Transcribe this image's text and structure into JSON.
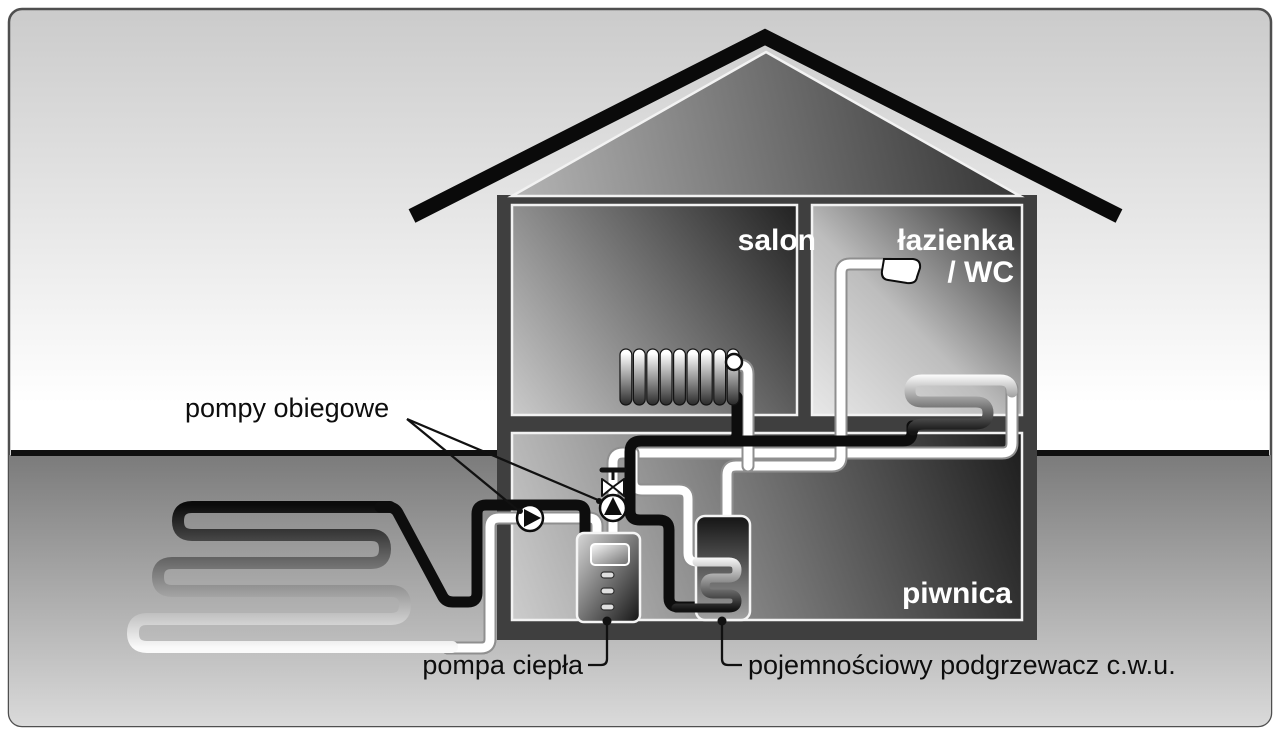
{
  "diagram": {
    "title": "heat-pump-house-cross-section",
    "rooms": {
      "salon": "salon",
      "bathroom_line1": "łazienka",
      "bathroom_line2": "/ WC",
      "basement": "piwnica"
    },
    "labels": {
      "circulation_pumps": "pompy obiegowe",
      "heat_pump": "pompa ciepła",
      "dhw_tank": "pojemnościowy podgrzewacz c.w.u."
    },
    "icons": {
      "circulation_pump": "circle-with-flow-triangle",
      "mixing_valve": "bowtie-valve-with-t-handle",
      "radiator": "finned-radiator",
      "towel_radiator": "serpentine-coil",
      "shower": "shower-head",
      "ground_loop": "horizontal-ground-collector"
    },
    "colors": {
      "roof": "#0a0a0a",
      "wall": "#3f3f3f",
      "pipe_hot": "#0d0d0d",
      "pipe_cold": "#ffffff",
      "ground_line": "#101010",
      "label_text": "#0d0d0d",
      "room_text": "#ffffff"
    }
  }
}
